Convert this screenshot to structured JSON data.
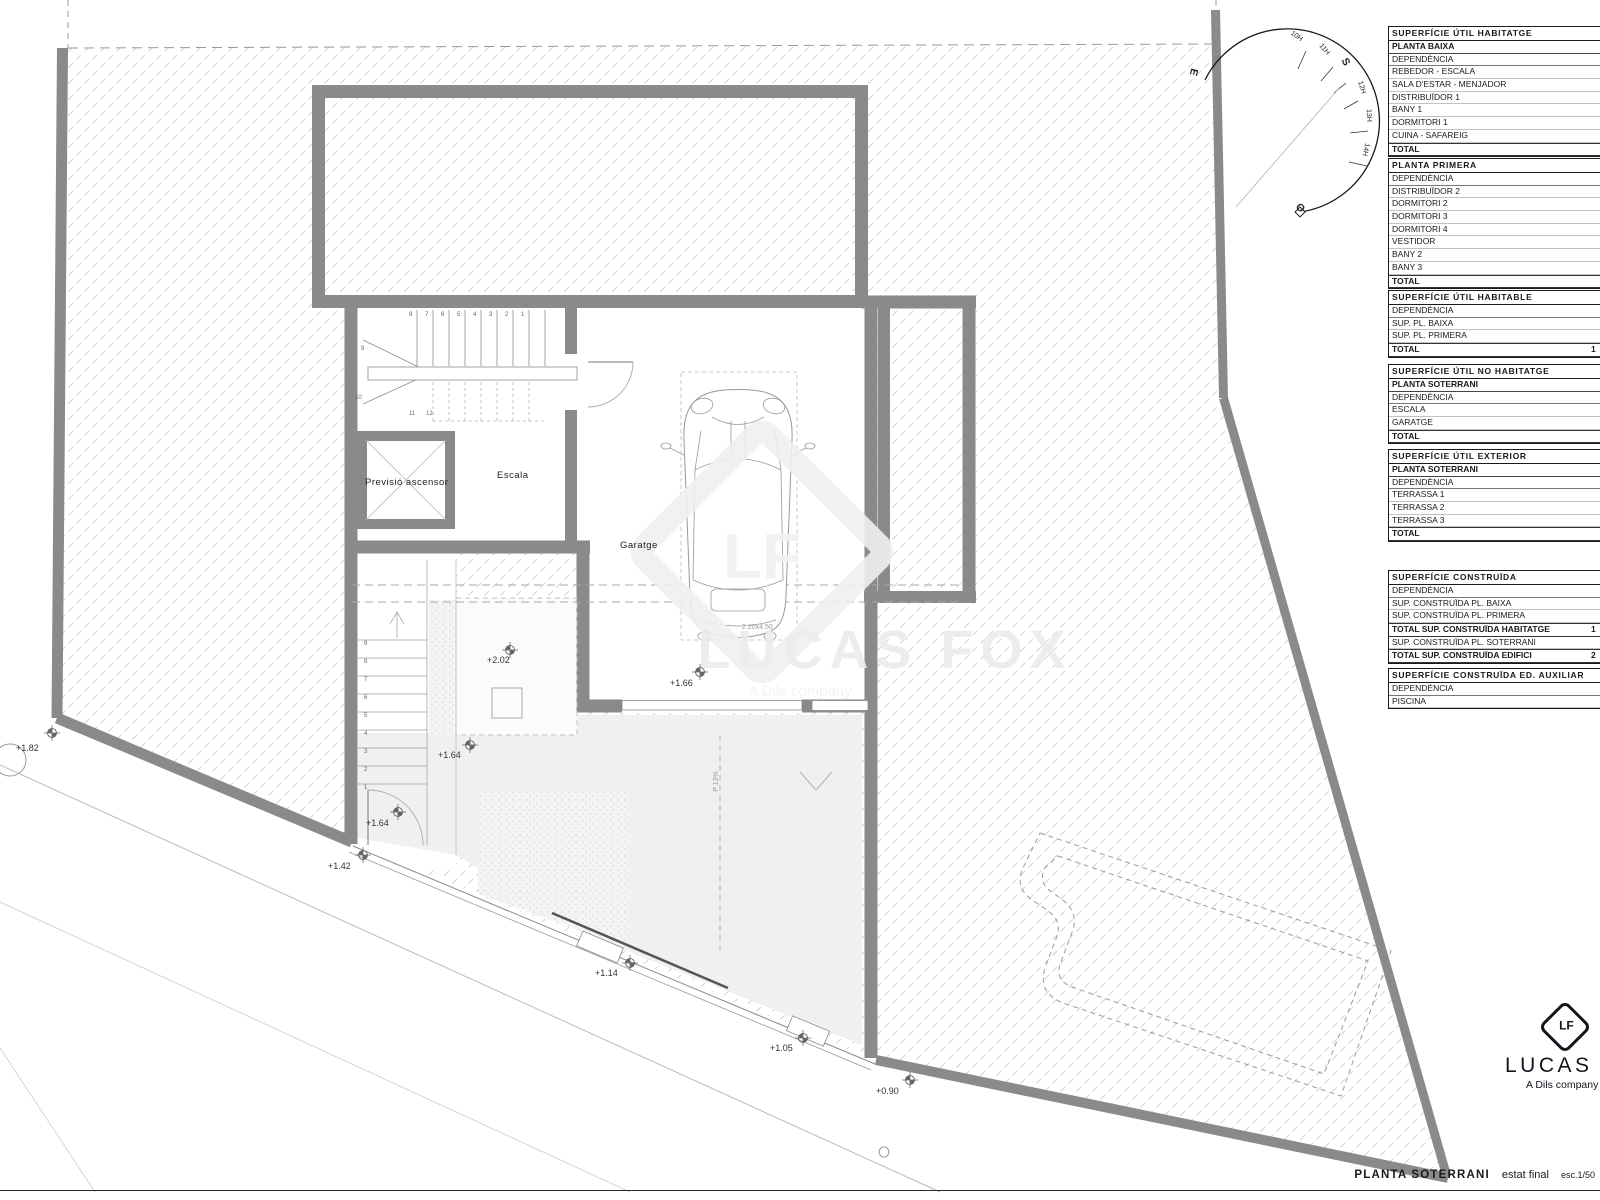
{
  "drawing": {
    "title": "PLANTA SOTERRANI",
    "state": "estat final",
    "scale": "esc.1/50"
  },
  "logo": {
    "monogram": "LF",
    "name": "LUCAS FOX",
    "tagline": "A Dils company"
  },
  "watermark": {
    "monogram": "LF",
    "name": "LUCAS FOX",
    "tagline": "A Dils company"
  },
  "compass": {
    "labels": [
      {
        "t": "E",
        "x": 1190,
        "y": 66,
        "r": 105,
        "c": "big"
      },
      {
        "t": "10H",
        "x": 1290,
        "y": 33,
        "r": 35
      },
      {
        "t": "11H",
        "x": 1318,
        "y": 46,
        "r": 50
      },
      {
        "t": "S",
        "x": 1342,
        "y": 56,
        "r": 62,
        "c": "big"
      },
      {
        "t": "12H",
        "x": 1355,
        "y": 84,
        "r": 74
      },
      {
        "t": "13H",
        "x": 1362,
        "y": 112,
        "r": 88
      },
      {
        "t": "14H",
        "x": 1359,
        "y": 146,
        "r": 103
      },
      {
        "t": "O",
        "x": 1296,
        "y": 202,
        "r": 45,
        "c": "big"
      }
    ]
  },
  "plan": {
    "rooms": [
      {
        "t": "Previsió ascensor",
        "x": 365,
        "y": 477
      },
      {
        "t": "Escala",
        "x": 497,
        "y": 470
      },
      {
        "t": "Garatge",
        "x": 620,
        "y": 540
      }
    ],
    "levels": [
      {
        "t": "+1.82",
        "x": 16,
        "y": 743
      },
      {
        "t": "+2.02",
        "x": 487,
        "y": 655
      },
      {
        "t": "+1.66",
        "x": 670,
        "y": 678
      },
      {
        "t": "+1.64",
        "x": 438,
        "y": 750
      },
      {
        "t": "+1.64",
        "x": 366,
        "y": 818
      },
      {
        "t": "+1.42",
        "x": 328,
        "y": 861
      },
      {
        "t": "+1.14",
        "x": 595,
        "y": 968
      },
      {
        "t": "+1.05",
        "x": 770,
        "y": 1043
      },
      {
        "t": "+0.90",
        "x": 876,
        "y": 1086
      }
    ],
    "notes": [
      {
        "t": "2.20x4.50",
        "x": 742,
        "y": 624
      },
      {
        "t": "P 13%",
        "x": 706,
        "y": 778,
        "r": -90
      }
    ],
    "stair_numbers": [
      {
        "t": "8",
        "x": 409,
        "y": 312
      },
      {
        "t": "7",
        "x": 425,
        "y": 312
      },
      {
        "t": "6",
        "x": 441,
        "y": 312
      },
      {
        "t": "5",
        "x": 457,
        "y": 312
      },
      {
        "t": "4",
        "x": 473,
        "y": 312
      },
      {
        "t": "3",
        "x": 489,
        "y": 312
      },
      {
        "t": "2",
        "x": 505,
        "y": 312
      },
      {
        "t": "1",
        "x": 521,
        "y": 312
      },
      {
        "t": "9",
        "x": 361,
        "y": 346
      },
      {
        "t": "10",
        "x": 355,
        "y": 395
      },
      {
        "t": "11",
        "x": 409,
        "y": 411
      },
      {
        "t": "12",
        "x": 426,
        "y": 411
      },
      {
        "t": "9",
        "x": 364,
        "y": 641
      },
      {
        "t": "8",
        "x": 364,
        "y": 659
      },
      {
        "t": "7",
        "x": 364,
        "y": 677
      },
      {
        "t": "6",
        "x": 364,
        "y": 695
      },
      {
        "t": "5",
        "x": 364,
        "y": 713
      },
      {
        "t": "4",
        "x": 364,
        "y": 731
      },
      {
        "t": "3",
        "x": 364,
        "y": 749
      },
      {
        "t": "2",
        "x": 364,
        "y": 767
      },
      {
        "t": "1",
        "x": 364,
        "y": 785
      }
    ]
  },
  "tables": [
    {
      "title": "SUPERFÍCIE ÚTIL HABITATGE",
      "rows": [
        {
          "t": "PLANTA BAIXA",
          "k": "sub"
        },
        {
          "t": "DEPENDÈNCIA",
          "k": "col"
        },
        {
          "t": "REBEDOR - ESCALA",
          "k": "item"
        },
        {
          "t": "SALA D'ESTAR - MENJADOR",
          "k": "item"
        },
        {
          "t": "DISTRIBUÏDOR 1",
          "k": "item"
        },
        {
          "t": "BANY 1",
          "k": "item"
        },
        {
          "t": "DORMITORI 1",
          "k": "item"
        },
        {
          "t": "CUINA - SAFAREIG",
          "k": "item"
        },
        {
          "t": "TOTAL",
          "k": "total"
        }
      ]
    },
    {
      "title": "PLANTA PRIMERA",
      "rows": [
        {
          "t": "DEPENDÈNCIA",
          "k": "col"
        },
        {
          "t": "DISTRIBUÏDOR 2",
          "k": "item"
        },
        {
          "t": "DORMITORI 2",
          "k": "item"
        },
        {
          "t": "DORMITORI 3",
          "k": "item"
        },
        {
          "t": "DORMITORI 4",
          "k": "item"
        },
        {
          "t": "VESTIDOR",
          "k": "item"
        },
        {
          "t": "BANY 2",
          "k": "item"
        },
        {
          "t": "BANY 3",
          "k": "item"
        },
        {
          "t": "TOTAL",
          "k": "total"
        }
      ]
    },
    {
      "title": "SUPERFÍCIE ÚTIL HABITABLE",
      "rows": [
        {
          "t": "DEPENDÈNCIA",
          "k": "col"
        },
        {
          "t": "SUP. PL. BAIXA",
          "k": "item"
        },
        {
          "t": "SUP. PL. PRIMERA",
          "k": "item"
        },
        {
          "t": "TOTAL",
          "k": "total",
          "v": "1"
        }
      ]
    },
    {
      "title": "SUPERFÍCIE ÚTIL NO HABITATGE",
      "rows": [
        {
          "t": "PLANTA SOTERRANI",
          "k": "sub"
        },
        {
          "t": "DEPENDÈNCIA",
          "k": "col"
        },
        {
          "t": "ESCALA",
          "k": "item"
        },
        {
          "t": "GARATGE",
          "k": "item"
        },
        {
          "t": "TOTAL",
          "k": "total"
        }
      ]
    },
    {
      "title": "SUPERFÍCIE ÚTIL EXTERIOR",
      "rows": [
        {
          "t": "PLANTA SOTERRANI",
          "k": "sub"
        },
        {
          "t": "DEPENDÈNCIA",
          "k": "col"
        },
        {
          "t": "TERRASSA 1",
          "k": "item"
        },
        {
          "t": "TERRASSA 2",
          "k": "item"
        },
        {
          "t": "TERRASSA 3",
          "k": "item"
        },
        {
          "t": "TOTAL",
          "k": "total"
        }
      ]
    },
    {
      "title": "SUPERFÍCIE CONSTRUÏDA",
      "rows": [
        {
          "t": "DEPENDÈNCIA",
          "k": "col"
        },
        {
          "t": "SUP. CONSTRUÏDA PL. BAIXA",
          "k": "item"
        },
        {
          "t": "SUP. CONSTRUÏDA PL. PRIMERA",
          "k": "item"
        },
        {
          "t": "TOTAL SUP. CONSTRUÏDA HABITATGE",
          "k": "total",
          "v": "1"
        },
        {
          "t": "SUP. CONSTRUÏDA PL. SOTERRANI",
          "k": "item"
        },
        {
          "t": "TOTAL SUP. CONSTRUÏDA EDIFICI",
          "k": "total",
          "v": "2"
        }
      ]
    },
    {
      "title": "SUPERFÍCIE CONSTRUÏDA ED. AUXILIAR",
      "rows": [
        {
          "t": "DEPENDÈNCIA",
          "k": "col"
        },
        {
          "t": "PISCINA",
          "k": "item"
        }
      ]
    }
  ]
}
